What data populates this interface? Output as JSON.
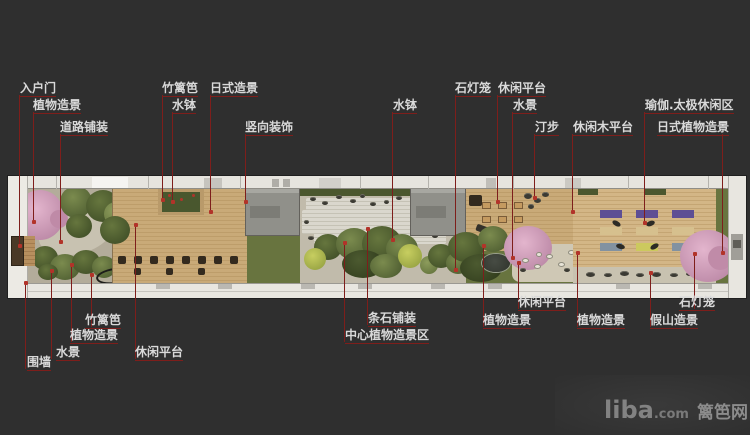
{
  "page": {
    "background_color": "#2f2f2f",
    "type_hint": "landscape garden plan with callout annotations"
  },
  "colors": {
    "leader_line": "#7e1e1b",
    "leader_dot": "#b23329",
    "label_text": "#d9d9d9",
    "plan_wall": "#e6e4de",
    "deck_wood": "#c9aa78",
    "gravel": "#c1bbab",
    "grass": "#68743f",
    "building": "#90908a",
    "cherry_pink": "#c997b5"
  },
  "annotations": {
    "top": [
      {
        "label": "入户门",
        "x": 20,
        "y": 82,
        "leader_x": 19,
        "leader_y1": 95,
        "leader_y2": 245
      },
      {
        "label": "植物造景",
        "x": 33,
        "y": 99,
        "leader_x": 33,
        "leader_y1": 112,
        "leader_y2": 221
      },
      {
        "label": "道路铺装",
        "x": 60,
        "y": 121,
        "leader_x": 60,
        "leader_y1": 134,
        "leader_y2": 241
      },
      {
        "label": "竹篱笆",
        "x": 162,
        "y": 82,
        "leader_x": 162,
        "leader_y1": 95,
        "leader_y2": 199
      },
      {
        "label": "水钵",
        "x": 172,
        "y": 99,
        "leader_x": 172,
        "leader_y1": 112,
        "leader_y2": 201
      },
      {
        "label": "日式造景",
        "x": 210,
        "y": 82,
        "leader_x": 210,
        "leader_y1": 95,
        "leader_y2": 211
      },
      {
        "label": "竖向装饰",
        "x": 245,
        "y": 121,
        "leader_x": 245,
        "leader_y1": 134,
        "leader_y2": 201
      },
      {
        "label": "水钵",
        "x": 393,
        "y": 99,
        "leader_x": 392,
        "leader_y1": 112,
        "leader_y2": 239
      },
      {
        "label": "石灯笼",
        "x": 455,
        "y": 82,
        "leader_x": 455,
        "leader_y1": 95,
        "leader_y2": 269
      },
      {
        "label": "休闲平台",
        "x": 498,
        "y": 82,
        "leader_x": 497,
        "leader_y1": 95,
        "leader_y2": 201
      },
      {
        "label": "水景",
        "x": 513,
        "y": 99,
        "leader_x": 512,
        "leader_y1": 112,
        "leader_y2": 257
      },
      {
        "label": "汀步",
        "x": 535,
        "y": 121,
        "leader_x": 534,
        "leader_y1": 134,
        "leader_y2": 197
      },
      {
        "label": "休闲木平台",
        "x": 573,
        "y": 121,
        "leader_x": 572,
        "leader_y1": 134,
        "leader_y2": 211
      },
      {
        "label": "瑜伽.太极休闲区",
        "x": 645,
        "y": 99,
        "leader_x": 644,
        "leader_y1": 112,
        "leader_y2": 222
      },
      {
        "label": "日式植物造景",
        "x": 657,
        "y": 121,
        "leader_x": 722,
        "leader_y1": 134,
        "leader_y2": 252
      }
    ],
    "bottom": [
      {
        "label": "围墙",
        "x": 27,
        "y": 356,
        "leader_x": 25,
        "leader_y1": 282,
        "leader_y2": 369
      },
      {
        "label": "水景",
        "x": 56,
        "y": 346,
        "leader_x": 51,
        "leader_y1": 270,
        "leader_y2": 359
      },
      {
        "label": "植物造景",
        "x": 70,
        "y": 329,
        "leader_x": 71,
        "leader_y1": 264,
        "leader_y2": 342
      },
      {
        "label": "竹篱笆",
        "x": 85,
        "y": 314,
        "leader_x": 91,
        "leader_y1": 274,
        "leader_y2": 327
      },
      {
        "label": "休闲平台",
        "x": 135,
        "y": 346,
        "leader_x": 135,
        "leader_y1": 224,
        "leader_y2": 359
      },
      {
        "label": "条石铺装",
        "x": 368,
        "y": 312,
        "leader_x": 367,
        "leader_y1": 228,
        "leader_y2": 325
      },
      {
        "label": "中心植物造景区",
        "x": 345,
        "y": 329,
        "leader_x": 344,
        "leader_y1": 242,
        "leader_y2": 342
      },
      {
        "label": "植物造景",
        "x": 483,
        "y": 314,
        "leader_x": 483,
        "leader_y1": 245,
        "leader_y2": 327
      },
      {
        "label": "休闲平台",
        "x": 518,
        "y": 296,
        "leader_x": 518,
        "leader_y1": 262,
        "leader_y2": 309
      },
      {
        "label": "植物造景",
        "x": 577,
        "y": 314,
        "leader_x": 577,
        "leader_y1": 252,
        "leader_y2": 327
      },
      {
        "label": "假山造景",
        "x": 650,
        "y": 314,
        "leader_x": 650,
        "leader_y1": 272,
        "leader_y2": 327
      },
      {
        "label": "石灯笼",
        "x": 679,
        "y": 296,
        "leader_x": 694,
        "leader_y1": 253,
        "leader_y2": 309
      }
    ]
  },
  "watermark": {
    "brand": "liba",
    "domain_suffix": ".com",
    "site_name": "篱笆网"
  }
}
